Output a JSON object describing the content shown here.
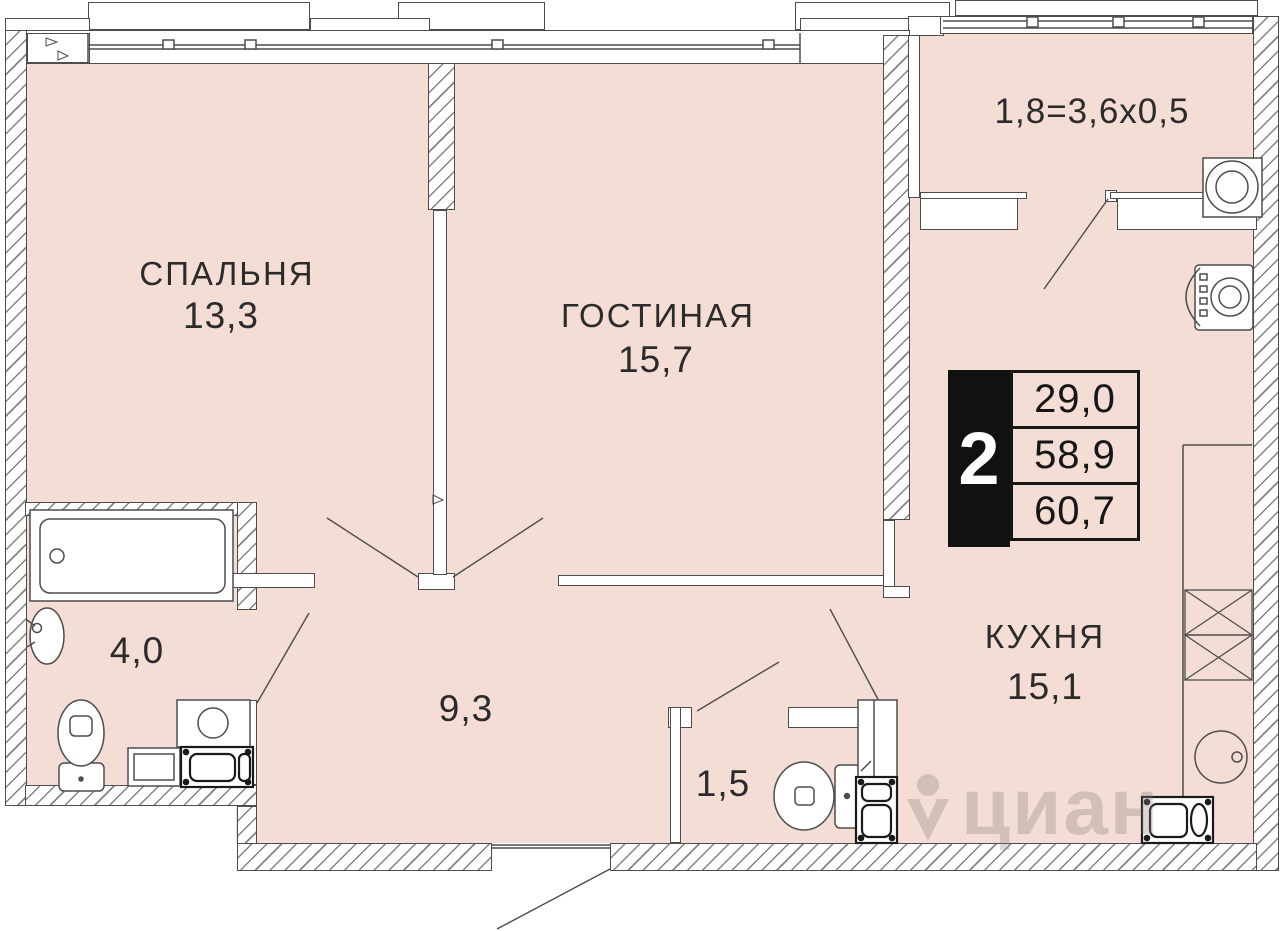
{
  "plan": {
    "rooms": {
      "bedroom": {
        "name": "СПАЛЬНЯ",
        "area": "13,3"
      },
      "living": {
        "name": "ГОСТИНАЯ",
        "area": "15,7"
      },
      "kitchen": {
        "name": "КУХНЯ",
        "area": "15,1"
      },
      "bathroom": {
        "area": "4,0"
      },
      "hallway": {
        "area": "9,3"
      },
      "wc": {
        "area": "1,5"
      }
    },
    "balcony": {
      "dimension": "1,8=3,6x0,5"
    },
    "info_badge": {
      "rooms_count": "2",
      "values": [
        "29,0",
        "58,9",
        "60,7"
      ]
    },
    "watermark": {
      "text": "циан"
    },
    "colors": {
      "floor": "#f3ddd4",
      "line": "#4d4d4d",
      "badge_bg": "#111111",
      "text": "#2b2b2b"
    }
  }
}
